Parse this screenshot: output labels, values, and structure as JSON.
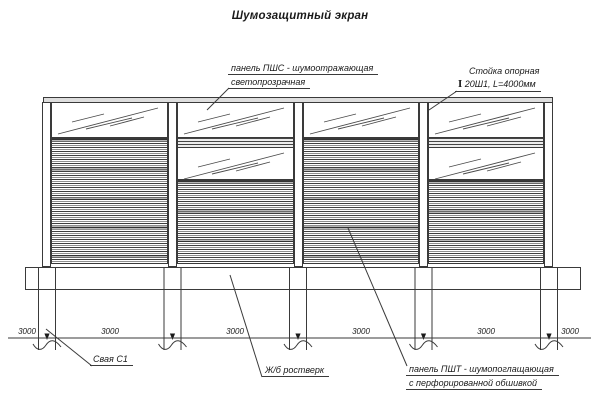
{
  "title": "Шумозащитный экран",
  "callouts": {
    "pshs": {
      "line1": "панель ПШС - шумоотражающая",
      "line2": "светопрозрачная"
    },
    "post": {
      "line1": "Стойка опорная",
      "symbol": "I",
      "line2": "20Ш1, L=4000мм"
    },
    "pile": {
      "label": "Свая С1"
    },
    "grillage": {
      "label": "Ж/б ростверк"
    },
    "psht": {
      "line1": "панель ПШТ - шумопоглащающая",
      "line2": "с перфорированной обшивкой"
    }
  },
  "dimensions": [
    "3000",
    "3000",
    "3000",
    "3000",
    "3000",
    "3000"
  ],
  "colors": {
    "line": "#3a3a3a",
    "background": "#ffffff",
    "cap_fill": "#dedede"
  }
}
